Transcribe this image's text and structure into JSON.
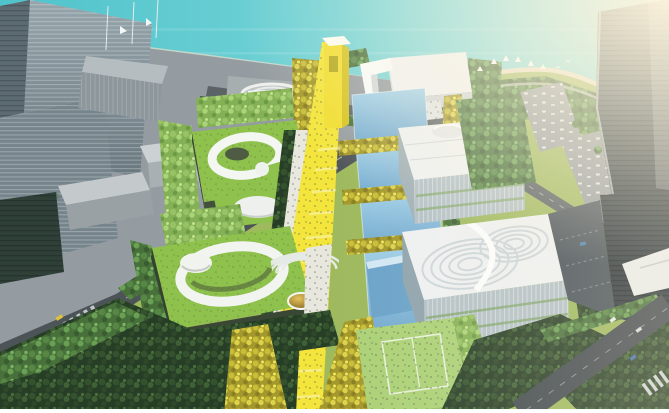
{
  "scene": {
    "type": "architectural-aerial-rendering",
    "description": "Aerial rendering of a waterfront cultural campus: a yellow central pedestrian axis with a yellow gateway tower, reflecting pools, two green-roof buildings with white ring ramps and an amphitheatre, white cube museums with patterned roofs, gray office towers on the left, a dark curved tower at the top right, coastal park, beach and turquoise sea, warm sunlight glare from the upper right."
  },
  "palette": {
    "sea_deep": "#4fc3cb",
    "sea_light": "#93e1e1",
    "sand": "#e7ddc3",
    "campus_green": "#9eb95e",
    "roof_green": "#8ec24c",
    "lawn_green": "#abd177",
    "axis_yellow": "#f3e53b",
    "gate_yellow": "#f1de30",
    "pool_blue_light": "#a3d2ea",
    "pool_blue_deep": "#74abd0",
    "forest_dark": "#263d26",
    "forest_medium": "#47703b",
    "tree_yellow": "#a3982b",
    "tree_lime": "#85b156",
    "city_gray": "#959ca1",
    "road_gray": "#4d5458",
    "building_white": "#eef1f2",
    "glass_blue": "#b3c1c7",
    "tower_dark": "#2c373d",
    "glare_warm": "#fff5dd"
  }
}
